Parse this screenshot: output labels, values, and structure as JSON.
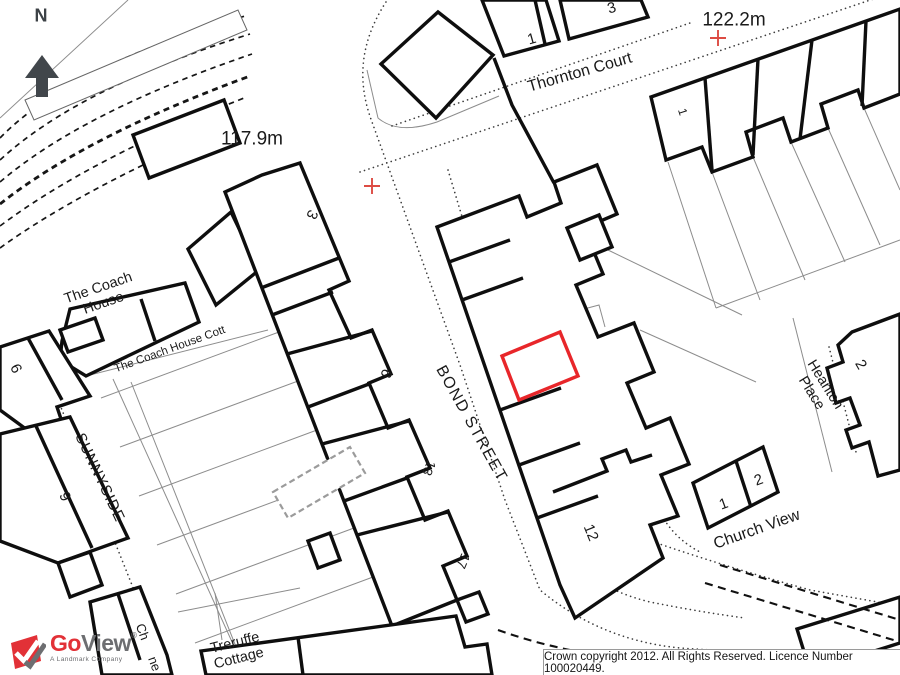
{
  "map": {
    "north": "N",
    "heights": {
      "h1": "117.9m",
      "h2": "122.2m"
    },
    "streets": {
      "thornton": "Thornton Court",
      "bond": "BOND STREET",
      "sunnyside": "SUNNYSIDE",
      "heanton_l1": "Heanton",
      "heanton_l2": "Place",
      "church": "Church View"
    },
    "buildings": {
      "coach_l1": "The Coach",
      "coach_l2": "House",
      "coach_cott": "The Coach House Cott",
      "treruffe_l1": "Treruffe",
      "treruffe_l2": "Cottage",
      "frag_ch": "Ch",
      "frag_ne": "ne"
    },
    "numbers": {
      "top1": "1",
      "top3": "3",
      "ne1": "1",
      "mid3": "3",
      "mid6": "6",
      "n13": "13",
      "n17": "17",
      "n12": "12",
      "left6": "6",
      "left9": "9",
      "heanton2": "2",
      "church1": "1",
      "church2": "2"
    },
    "colors": {
      "plot_highlight": "#e8262a",
      "spot_cross": "#dd4b43"
    }
  },
  "logo": {
    "go": "Go",
    "view": "View",
    "reg": "®",
    "tagline": "A Landmark Company"
  },
  "footer": {
    "copyright": "Crown copyright 2012. All Rights Reserved. Licence Number 100020449."
  }
}
